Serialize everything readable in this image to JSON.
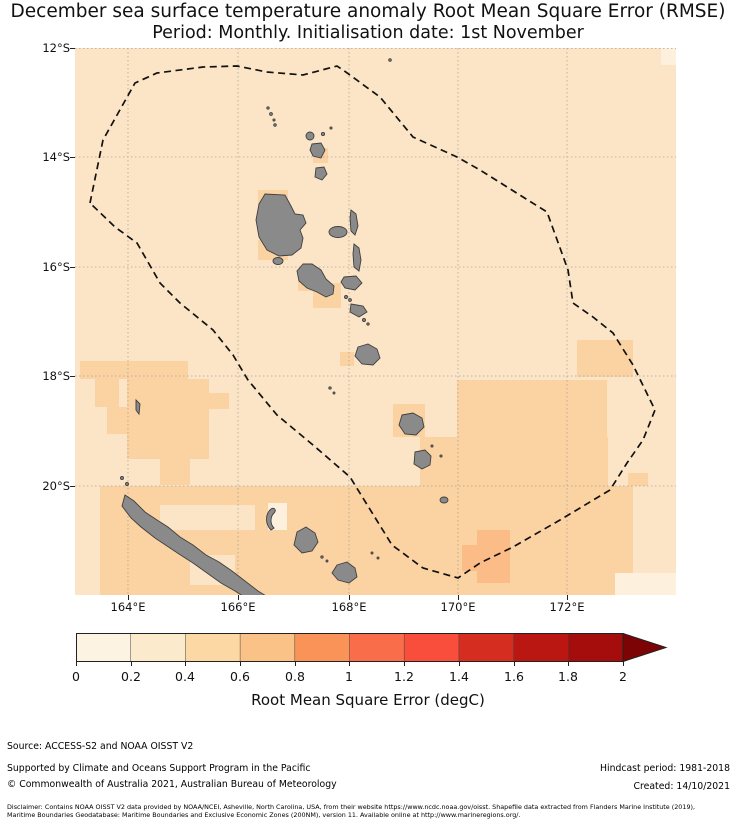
{
  "title": {
    "line1": "December sea surface temperature anomaly Root Mean Square Error (RMSE)",
    "line2": "Period: Monthly. Initialisation date: 1st November"
  },
  "map": {
    "lat_labels": [
      "12°S",
      "14°S",
      "16°S",
      "18°S",
      "20°S"
    ],
    "lon_labels": [
      "164°E",
      "166°E",
      "168°E",
      "170°E",
      "172°E"
    ],
    "bin_colors": {
      "b1": "#fdf1de",
      "b2": "#fce5c6",
      "b3": "#fbd3a2",
      "b4": "#fbbc87"
    },
    "island_fill": "#8a8a8a",
    "island_stroke": "#3f3f3f",
    "eez_color": "#111111",
    "patches": [
      {
        "x": 5,
        "y": 313,
        "w": 108,
        "h": 18,
        "b": "b3"
      },
      {
        "x": 20,
        "y": 331,
        "w": 24,
        "h": 28,
        "b": "b3"
      },
      {
        "x": 52,
        "y": 331,
        "w": 82,
        "h": 80,
        "b": "b3"
      },
      {
        "x": 85,
        "y": 411,
        "w": 30,
        "h": 26,
        "b": "b3"
      },
      {
        "x": 134,
        "y": 345,
        "w": 20,
        "h": 16,
        "b": "b3"
      },
      {
        "x": 32,
        "y": 359,
        "w": 20,
        "h": 27,
        "b": "b3"
      },
      {
        "x": 382,
        "y": 332,
        "w": 150,
        "h": 57,
        "b": "b3"
      },
      {
        "x": 345,
        "y": 389,
        "w": 188,
        "h": 49,
        "b": "b3"
      },
      {
        "x": 502,
        "y": 292,
        "w": 56,
        "h": 37,
        "b": "b3"
      },
      {
        "x": 553,
        "y": 425,
        "w": 20,
        "h": 13,
        "b": "b3"
      },
      {
        "x": 318,
        "y": 356,
        "w": 32,
        "h": 33,
        "b": "b3"
      },
      {
        "x": 25,
        "y": 438,
        "w": 276,
        "h": 109,
        "b": "b3"
      },
      {
        "x": 301,
        "y": 438,
        "w": 257,
        "h": 109,
        "b": "b3"
      },
      {
        "x": 183,
        "y": 142,
        "w": 30,
        "h": 28,
        "b": "b3"
      },
      {
        "x": 183,
        "y": 192,
        "w": 30,
        "h": 20,
        "b": "b3"
      },
      {
        "x": 238,
        "y": 100,
        "w": 15,
        "h": 15,
        "b": "b3"
      },
      {
        "x": 223,
        "y": 227,
        "w": 14,
        "h": 16,
        "b": "b3"
      },
      {
        "x": 238,
        "y": 235,
        "w": 28,
        "h": 25,
        "b": "b3"
      },
      {
        "x": 265,
        "y": 304,
        "w": 14,
        "h": 14,
        "b": "b3"
      },
      {
        "x": 85,
        "y": 457,
        "w": 95,
        "h": 25,
        "b": "b2"
      },
      {
        "x": 115,
        "y": 507,
        "w": 45,
        "h": 30,
        "b": "b2"
      },
      {
        "x": 0,
        "y": 495,
        "w": 25,
        "h": 35,
        "b": "b2"
      },
      {
        "x": 558,
        "y": 438,
        "w": 43,
        "h": 57,
        "b": "b2"
      },
      {
        "x": 193,
        "y": 455,
        "w": 19,
        "h": 27,
        "b": "b1"
      },
      {
        "x": 540,
        "y": 525,
        "w": 61,
        "h": 22,
        "b": "b1"
      },
      {
        "x": 586,
        "y": 0,
        "w": 15,
        "h": 17,
        "b": "b1"
      },
      {
        "x": 402,
        "y": 482,
        "w": 33,
        "h": 53,
        "b": "b4"
      },
      {
        "x": 387,
        "y": 497,
        "w": 16,
        "h": 26,
        "b": "b4"
      }
    ]
  },
  "colorbar": {
    "label": "Root Mean Square Error (degC)",
    "ticks": [
      "0",
      "0.2",
      "0.4",
      "0.6",
      "0.8",
      "1",
      "1.2",
      "1.4",
      "1.6",
      "1.8",
      "2"
    ],
    "segment_colors": [
      "#fdf3e3",
      "#fceacd",
      "#fcd9a4",
      "#fbc288",
      "#fa9357",
      "#f96d4a",
      "#f94e3b",
      "#d52e21",
      "#bb1712",
      "#a40d0b"
    ],
    "arrow_color": "#7c0404"
  },
  "footer": {
    "source": "Source: ACCESS-S2 and NOAA OISST V2",
    "supported": "Supported by Climate and Oceans Support Program in the Pacific",
    "copyright": "© Commonwealth of Australia 2021, Australian Bureau of Meteorology",
    "hindcast": "Hindcast period: 1981-2018",
    "created": "Created: 14/10/2021",
    "disclaimer": "Disclaimer: Contains NOAA OISST V2 data provided by NOAA/NCEI, Asheville, North Carolina, USA, from their website https://www.ncdc.noaa.gov/oisst. Shapefile data extracted from Flanders Marine Institute (2019), Maritime Boundaries Geodatabase: Maritime Boundaries and Exclusive Economic Zones (200NM), version 11. Available online at http://www.marineregions.org/."
  },
  "chart_data": {
    "type": "heatmap",
    "title": "December sea surface temperature anomaly Root Mean Square Error (RMSE)",
    "subtitle": "Period: Monthly. Initialisation date: 1st November",
    "x": {
      "tick_values_deg_east": [
        164,
        166,
        168,
        170,
        172
      ],
      "range_deg_east": [
        163,
        174
      ]
    },
    "y": {
      "tick_values_deg_south": [
        12,
        14,
        16,
        18,
        20
      ],
      "range_deg_south": [
        12,
        22
      ]
    },
    "colorbar": {
      "label": "Root Mean Square Error (degC)",
      "tick_values": [
        0,
        0.2,
        0.4,
        0.6,
        0.8,
        1,
        1.2,
        1.4,
        1.6,
        1.8,
        2
      ],
      "bin_width": 0.2,
      "extend": "max"
    },
    "field_summary": {
      "dominant_value_bin_degC": "0.2-0.4",
      "bin_0.4-0.6_degC": "patches southwest of Vanuatu EEZ (163-165.5E, 17.5-19.5S); broad area southeast of the EEZ (169-174E, 18-21S); band south of 20S surrounding New Caledonia and the Loyalty Islands; small coastal cells around Espiritu Santo, Vanua Lava, Malakula and Efate",
      "bin_0.6-0.8_degC": "small patch near 168.3-169.2E, 21.7-22S",
      "bin_0-0.2_degC": "isolated pale cells at the far southeast corner (~171.8-174E, 21.6-22S) and the northeast corner",
      "overlays": "black dashed polygon = Vanuatu EEZ boundary; grey land = Vanuatu archipelago and New Caledonia; dotted graticule every 2 degrees"
    }
  }
}
